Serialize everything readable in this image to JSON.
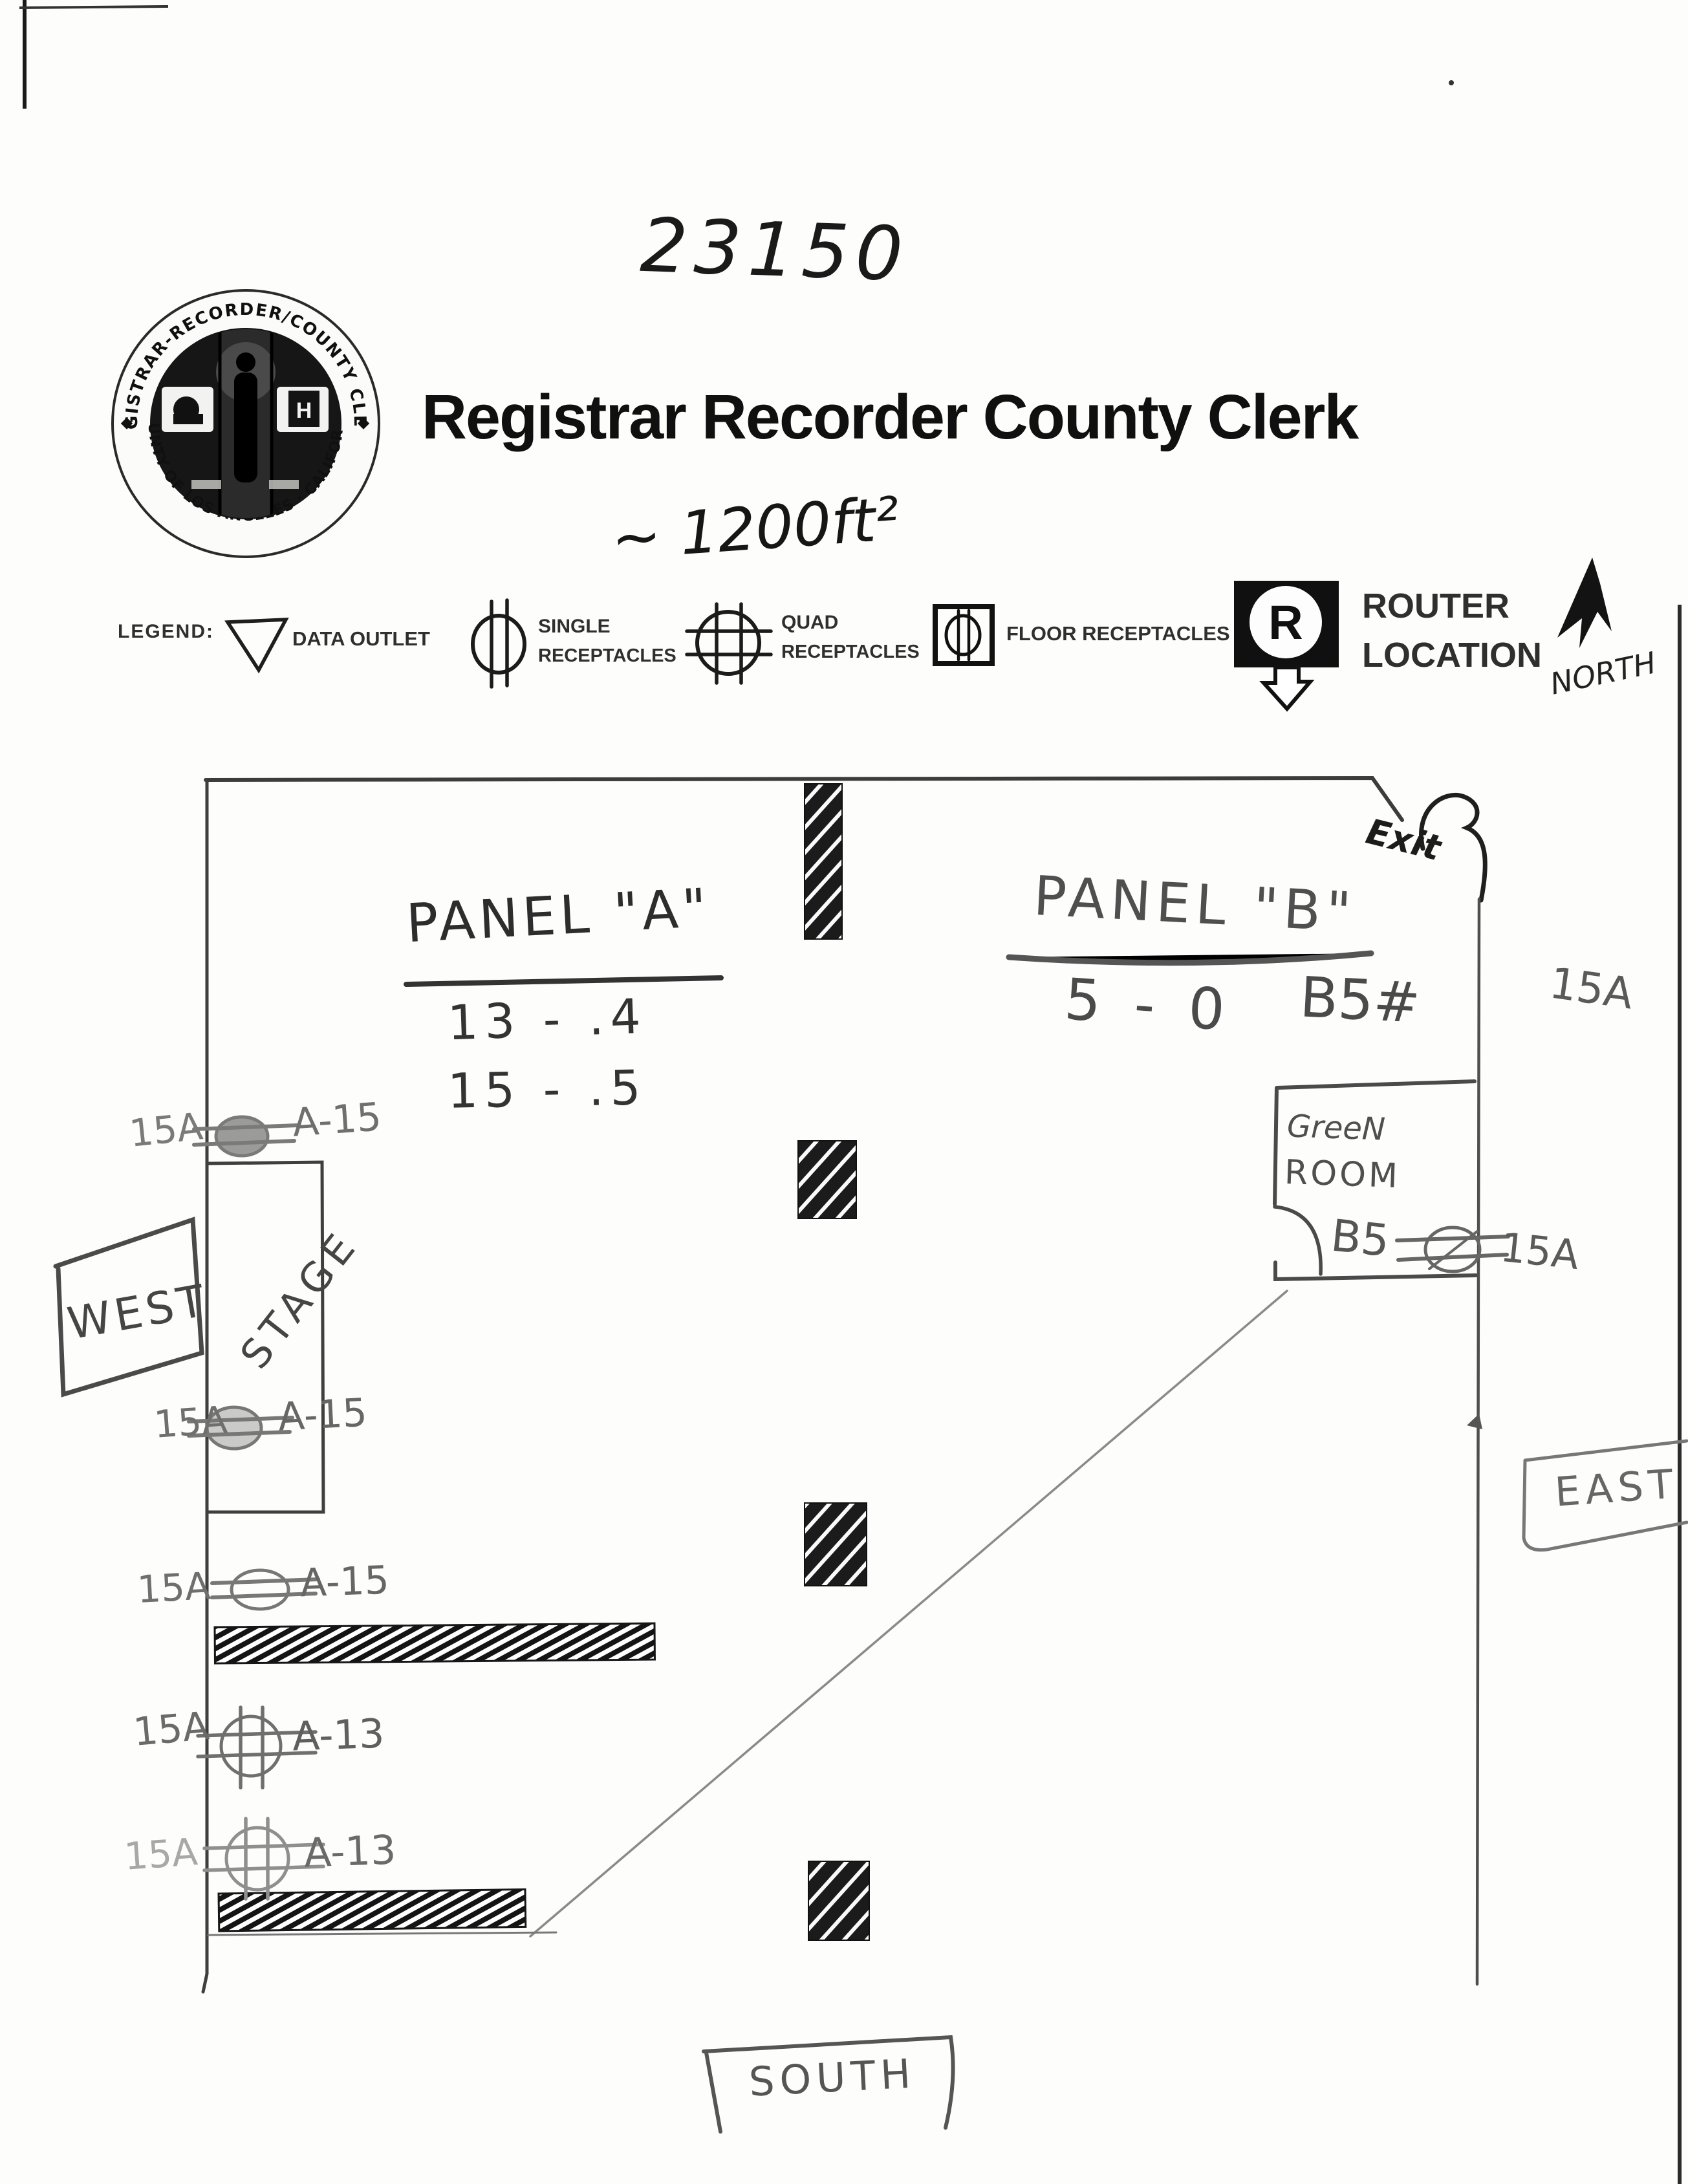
{
  "page": {
    "job_number": "23150",
    "title": "Registrar Recorder County Clerk",
    "area_note": "~ 1200ft²"
  },
  "seal": {
    "arc_top": "REGISTRAR-RECORDER/COUNTY CLERK",
    "arc_bottom": "COUNTY OF LOS ANGELES · CALIFORNIA",
    "monogram": "H"
  },
  "legend": {
    "heading": "LEGEND:",
    "data_outlet_label": "DATA OUTLET",
    "single_line1": "SINGLE",
    "single_line2": "RECEPTACLES",
    "quad_line1": "QUAD",
    "quad_line2": "RECEPTACLES",
    "floor_label": "FLOOR RECEPTACLES",
    "router_symbol_letter": "R",
    "router_line1": "ROUTER",
    "router_line2": "LOCATION",
    "north_label": "NORTH"
  },
  "plan": {
    "panel_a": {
      "title": "PANEL \"A\"",
      "row1": "13 - .4",
      "row2": "15 - .5"
    },
    "panel_b": {
      "title": "PANEL \"B\"",
      "row1": "5 - 0",
      "row2": "B5#",
      "row3": "15A"
    },
    "exit_label": "Exit",
    "green_room": {
      "line1": "GreeN",
      "line2": "ROOM",
      "note_prefix": "B5",
      "note_suffix": "15A"
    },
    "stage_label": "STAGE",
    "west_label": "WEST",
    "east_label": "EAST",
    "south_label": "SOUTH",
    "outlets": [
      {
        "amp": "15A",
        "circuit": "A-15"
      },
      {
        "amp": "15A",
        "circuit": "A-15"
      },
      {
        "amp": "15A",
        "circuit": "A-15"
      },
      {
        "amp": "15A",
        "circuit": "A-13"
      },
      {
        "amp": "15A",
        "circuit": "A-13"
      }
    ]
  },
  "colors": {
    "ink": "#1a1a1a",
    "pencil": "#555555",
    "pencil_light": "#8a8a8a",
    "paper": "#fdfdfb"
  }
}
